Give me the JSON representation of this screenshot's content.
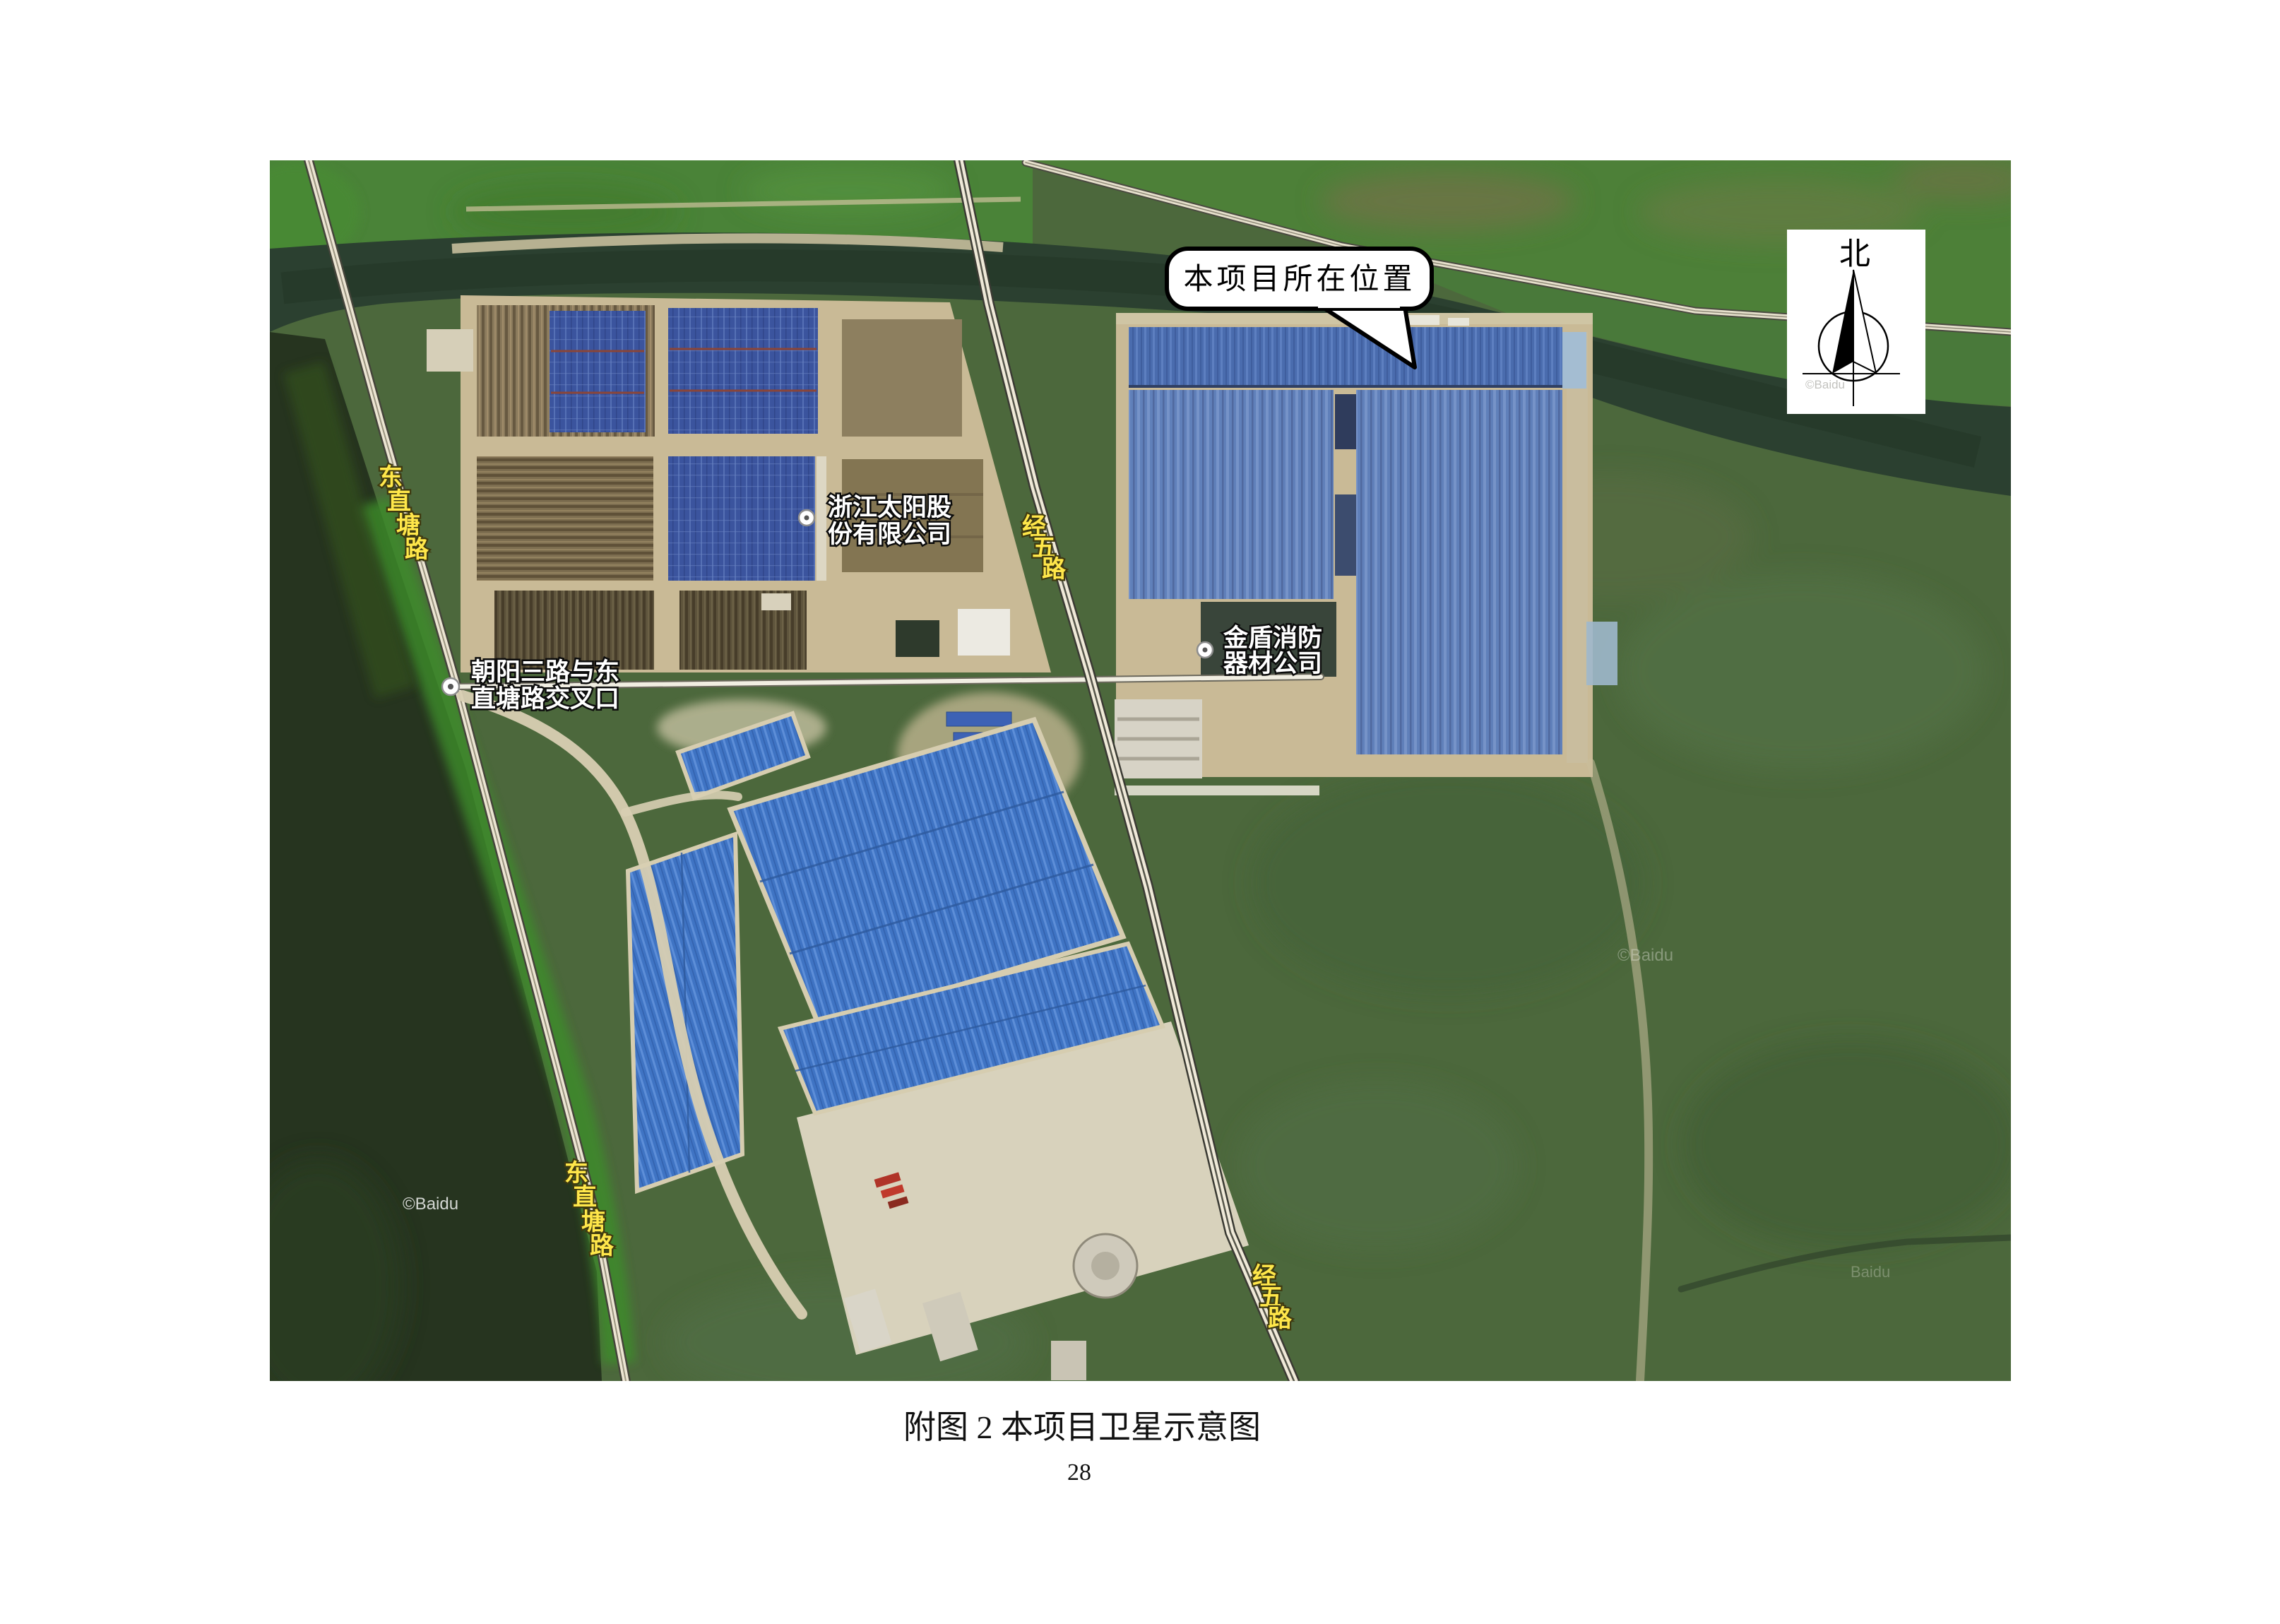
{
  "page": {
    "caption": "附图 2  本项目卫星示意图",
    "page_number": "28"
  },
  "map": {
    "type": "baidu-satellite-figure",
    "callout": {
      "text": "本项目所在位置"
    },
    "compass": {
      "north_label": "北"
    },
    "poi": [
      {
        "name": "浙江太阳股份有限公司",
        "line1": "浙江太阳股",
        "line2": "份有限公司"
      },
      {
        "name": "金盾消防器材公司",
        "line1": "金盾消防",
        "line2": "器材公司"
      },
      {
        "name": "朝阳三路与东直塘路交叉口",
        "line1": "朝阳三路与东",
        "line2": "直塘路交叉口"
      }
    ],
    "road_labels": [
      {
        "name": "东直塘路",
        "chars": [
          "东",
          "直",
          "塘",
          "路"
        ]
      },
      {
        "name": "经五路",
        "chars": [
          "经",
          "五",
          "路"
        ]
      },
      {
        "name": "经五路",
        "chars": [
          "经",
          "五",
          "路"
        ]
      },
      {
        "name": "东直塘路",
        "chars": [
          "东",
          "直",
          "塘",
          "路"
        ]
      }
    ],
    "watermarks": {
      "baidu": "©Baidu",
      "baidu_plain": "Baidu"
    },
    "colors": {
      "field_green": "#4c683c",
      "bright_green": "#4e8a38",
      "river_dark": "#2b4030",
      "road_light": "#ece5d2",
      "factory_blue": "#6080ba",
      "warehouse_blue": "#3f74c4",
      "solar_navy": "#3b549e",
      "compound_tan": "#c9ba96",
      "label_yellow": "#ffe74a"
    }
  }
}
